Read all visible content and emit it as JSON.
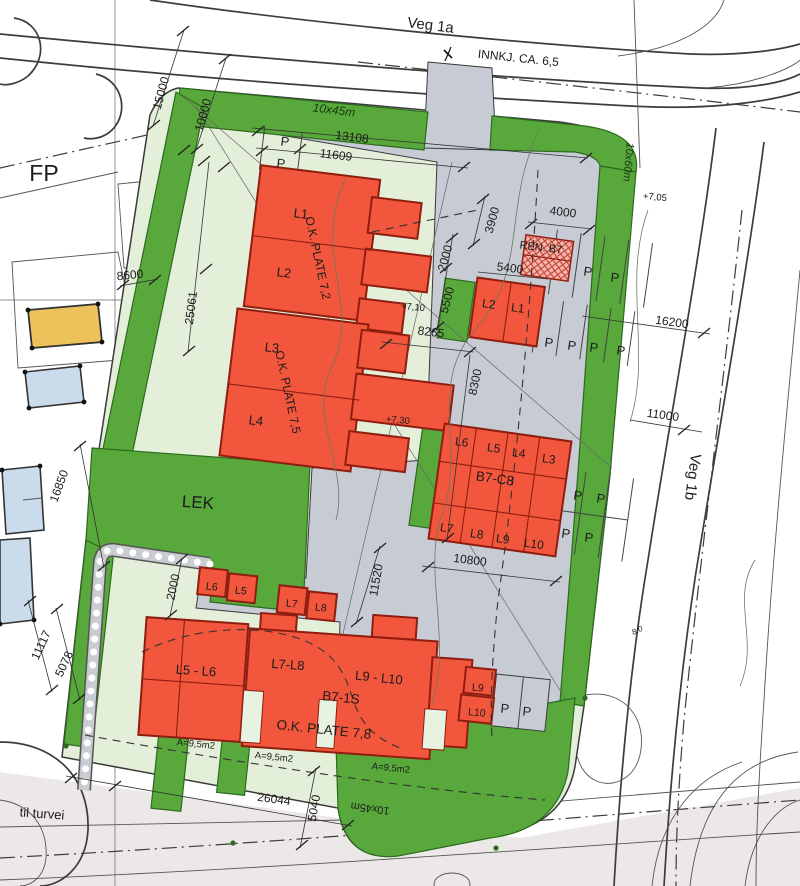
{
  "roads": {
    "veg_1a": "Veg 1a",
    "veg_1b": "Veg 1b",
    "entrance_note": "INNKJ. CA. 6,5",
    "path_note": "til turvei"
  },
  "areas": {
    "fp": "FP",
    "lek": "LEK",
    "green_strip_top": "10x45m",
    "green_strip_right": "10x60m",
    "green_strip_bottom": "10x45m",
    "waste_station": "REN. B7"
  },
  "parking": {
    "stall": "P"
  },
  "elevations": {
    "e705": "+7,05",
    "e710": "+7,10",
    "e730": "+7,30",
    "contour": "8.0"
  },
  "buildings": {
    "b7_west": {
      "u1": "L1",
      "u2": "L2",
      "u3": "L3",
      "u4": "L4",
      "plate_upper": "O.K. PLATE 7,2",
      "plate_lower": "O.K. PLATE 7,5"
    },
    "b7_small": {
      "left": "L2",
      "right": "L1"
    },
    "b7_c8": {
      "name": "B7-C8",
      "t1": "L6",
      "t2": "L5",
      "t3": "L4",
      "t4": "L3",
      "b1": "L7",
      "b2": "L8",
      "b3": "L9",
      "b4": "L10"
    },
    "b7_1s": {
      "name": "B7-1S",
      "left": "L5 - L6",
      "mid": "L7-L8",
      "right": "L9 - L10",
      "plate": "O.K. PLATE 7,8",
      "area1": "A=9,5m2",
      "area2": "A=9,5m2",
      "area3": "A=9,5m2"
    },
    "north_boxes": {
      "a": "L6",
      "b": "L5",
      "c": "L7",
      "d": "L8"
    },
    "south_boxes": {
      "a": "L9",
      "b": "L10"
    }
  },
  "dimensions": {
    "d15000": "15000",
    "d10000": "10000",
    "d13108": "13108",
    "d11609": "11609",
    "d8600": "8600",
    "d25061": "25061",
    "d3900": "3900",
    "d4000": "4000",
    "d2000_top": "2000",
    "d5400": "5400",
    "d5500": "5500",
    "d8265": "8265",
    "d8300": "8300",
    "d16200": "16200",
    "d11000": "11000",
    "d16850": "16850",
    "d11117": "11117",
    "d5078": "5078",
    "d2000_lek": "2000",
    "d11520": "11520",
    "d10800": "10800",
    "d26044": "26044",
    "d5040": "5040"
  },
  "colors": {
    "building": "#f2563c",
    "green": "#58a83c",
    "mint": "#e4efda",
    "courtyard": "#c7cbd4",
    "waste_fill": "#f2b7ae",
    "existing_yellow": "#eec25b",
    "existing_blue": "#cadcec"
  }
}
